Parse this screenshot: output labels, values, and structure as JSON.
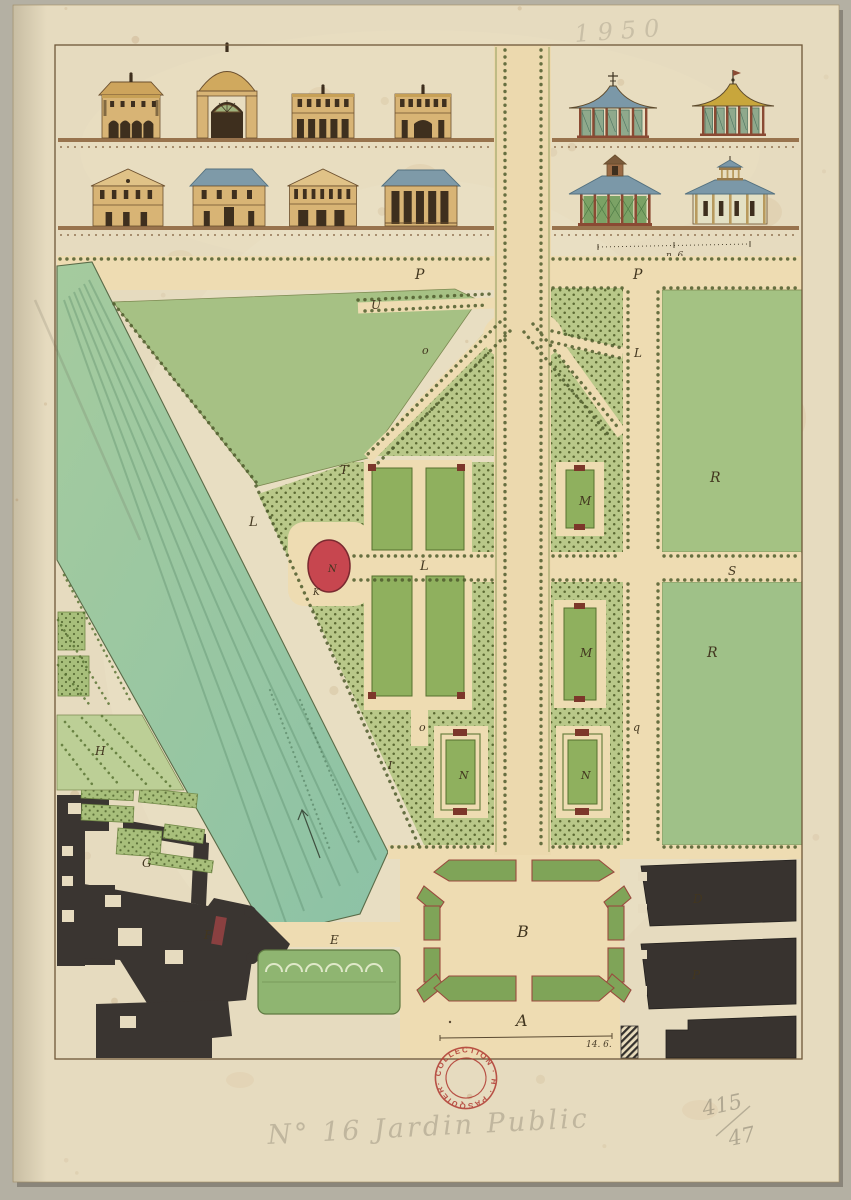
{
  "palette": {
    "mat": "#b4b0a3",
    "paper": "#e6dbbf",
    "path_tan": "#eedcb2",
    "lawn": "#a6c184",
    "bosquet": "#b9c889",
    "canal_top": "#a5cb9e",
    "canal_bottom": "#8cc2a6",
    "bed_green": "#8fb05e",
    "hedge_green": "#7fa458",
    "basin_red": "#c7464f",
    "corner_red": "#7c372a",
    "building_black": "#38332f",
    "ink_brown": "#42361f",
    "stamp_red": "#b03a31",
    "roof_blue": "#7b98a8",
    "roof_gold": "#c8a63c",
    "wall_tan": "#d8b475"
  },
  "inscriptions": {
    "top_pencil": "1950",
    "bottom_pencil": "N° 16  Jardin Public",
    "bottom_right_numerator": "415",
    "bottom_right_denominator": "47",
    "stamp_text": "· COLLECTION · H · PASQUIER"
  },
  "scales": {
    "top_scale_label": "n. 6.",
    "bottom_scale_label": "14. 6."
  },
  "plan": {
    "labels": [
      {
        "t": "P",
        "x": 415,
        "y": 279,
        "s": 14
      },
      {
        "t": "P",
        "x": 633,
        "y": 279,
        "s": 14
      },
      {
        "t": "U",
        "x": 371,
        "y": 309,
        "s": 12
      },
      {
        "t": "o",
        "x": 422,
        "y": 354,
        "s": 11
      },
      {
        "t": "L",
        "x": 634,
        "y": 357,
        "s": 12
      },
      {
        "t": "T",
        "x": 340,
        "y": 474,
        "s": 12
      },
      {
        "t": "L",
        "x": 249,
        "y": 526,
        "s": 13
      },
      {
        "t": "L",
        "x": 420,
        "y": 570,
        "s": 13
      },
      {
        "t": "N",
        "x": 328,
        "y": 572,
        "s": 10,
        "f": "#3c2026"
      },
      {
        "t": "K",
        "x": 313,
        "y": 595,
        "s": 9
      },
      {
        "t": "M",
        "x": 579,
        "y": 505,
        "s": 12
      },
      {
        "t": "M",
        "x": 580,
        "y": 657,
        "s": 12
      },
      {
        "t": "S",
        "x": 728,
        "y": 575,
        "s": 12
      },
      {
        "t": "R",
        "x": 710,
        "y": 482,
        "s": 14
      },
      {
        "t": "R",
        "x": 707,
        "y": 657,
        "s": 14
      },
      {
        "t": "o",
        "x": 419,
        "y": 731,
        "s": 11
      },
      {
        "t": "q",
        "x": 633,
        "y": 731,
        "s": 11
      },
      {
        "t": "I",
        "x": 388,
        "y": 769,
        "s": 11
      },
      {
        "t": "N",
        "x": 459,
        "y": 779,
        "s": 11
      },
      {
        "t": "N",
        "x": 581,
        "y": 779,
        "s": 11
      },
      {
        "t": "H",
        "x": 95,
        "y": 755,
        "s": 12
      },
      {
        "t": "G",
        "x": 142,
        "y": 867,
        "s": 12
      },
      {
        "t": "F",
        "x": 204,
        "y": 939,
        "s": 12
      },
      {
        "t": "E",
        "x": 330,
        "y": 944,
        "s": 12
      },
      {
        "t": "B",
        "x": 517,
        "y": 937,
        "s": 16
      },
      {
        "t": "A",
        "x": 516,
        "y": 1026,
        "s": 16
      },
      {
        "t": "D",
        "x": 693,
        "y": 903,
        "s": 12,
        "f": "#6e675e"
      },
      {
        "t": "P",
        "x": 692,
        "y": 979,
        "s": 12,
        "f": "#6e675e"
      }
    ]
  },
  "elevations": {
    "buildings": [
      {
        "name": "arcaded-pavilion",
        "type": "arcade",
        "x": 131,
        "base": 138,
        "w": 58
      },
      {
        "name": "domed-portal-pavilion",
        "type": "portal",
        "x": 227,
        "base": 138,
        "w": 60
      },
      {
        "name": "colonnaded-casino",
        "type": "colonnade2",
        "x": 323,
        "base": 138,
        "w": 62
      },
      {
        "name": "arched-casino",
        "type": "colonnade2",
        "x": 423,
        "base": 138,
        "w": 56,
        "arch": true
      },
      {
        "name": "pagoda-with-cross",
        "type": "pagoda",
        "x": 613,
        "base": 138,
        "w": 72,
        "roof": "#7b98a8",
        "finial": "cross"
      },
      {
        "name": "pagoda-with-vane",
        "type": "pagoda",
        "x": 733,
        "base": 136,
        "w": 66,
        "roof": "#c8a63c",
        "finial": "vane"
      },
      {
        "name": "pedimented-house",
        "type": "house-pediment",
        "x": 128,
        "base": 226,
        "w": 70
      },
      {
        "name": "hipped-roof-house",
        "type": "house-hip",
        "x": 229,
        "base": 226,
        "w": 72
      },
      {
        "name": "pedimented-gallery-house",
        "type": "gallery-pediment",
        "x": 323,
        "base": 226,
        "w": 67
      },
      {
        "name": "tall-colonnade-house",
        "type": "tall-colonnade",
        "x": 421,
        "base": 226,
        "w": 72
      },
      {
        "name": "tent-roof-pavilion",
        "type": "tent-lantern",
        "x": 615,
        "base": 226,
        "w": 74
      },
      {
        "name": "belvedere-pavilion",
        "type": "belvedere",
        "x": 730,
        "base": 224,
        "w": 74
      },
      {
        "name": "villa-on-lawn",
        "type": "hip-villa",
        "x": 727,
        "base": 382,
        "w": 112
      }
    ]
  }
}
